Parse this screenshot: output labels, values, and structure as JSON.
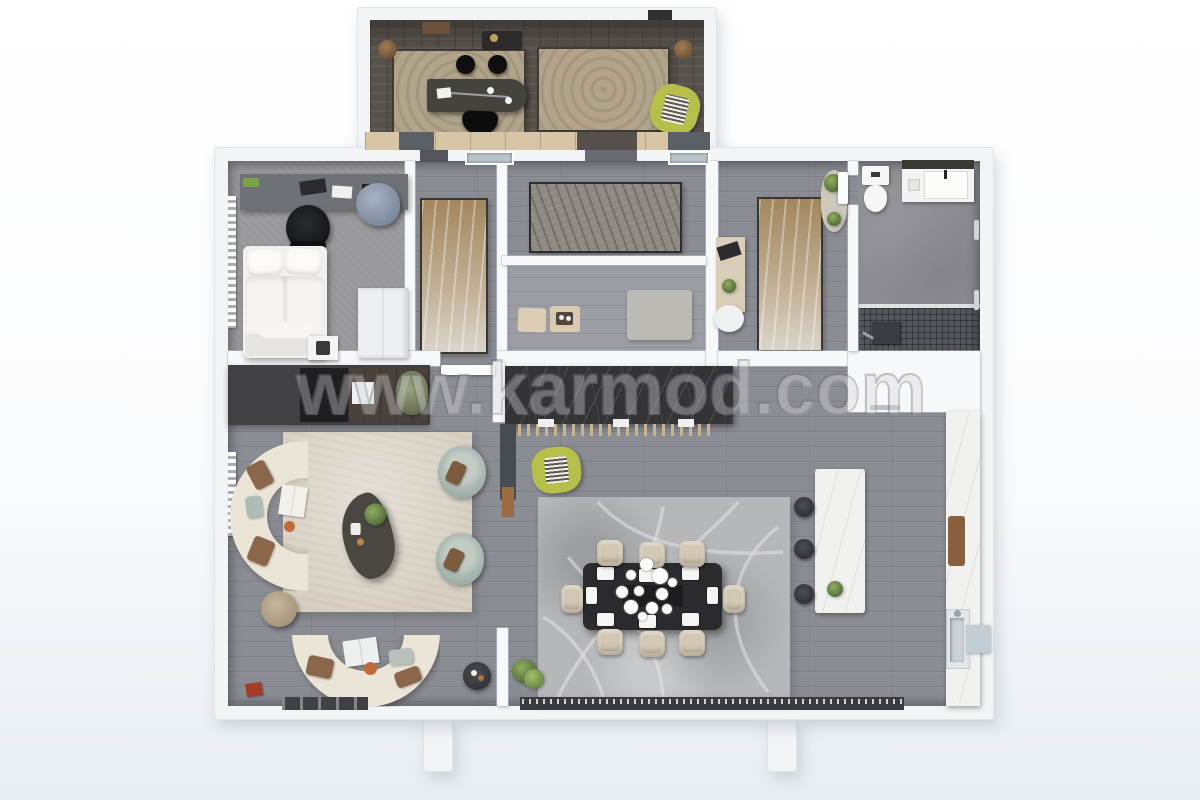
{
  "watermark": {
    "text": "www.karmod.com"
  },
  "scene": {
    "type": "3d-floor-plan-top-view",
    "blocks": [
      "studio-annex",
      "main-house"
    ],
    "colors": {
      "page_bg_bottom": "#e9eef3",
      "outer_wall": "#f2f4f6",
      "floor_wood_gray": "#8b8d94",
      "floor_wood_dark": "#57514b",
      "bedroom_carpet": "#98979a",
      "bathroom_stone": "#8d8c92",
      "shower_mosaic": "#53555c",
      "rug_cream": "#d8d1c3",
      "rug_tan": "#ab9069",
      "rug_beige": "#b2a48b",
      "rug_dining": "#b5b7ba",
      "sofa_cream": "#ebe5d7",
      "armchair_teal": "#a9b7b0",
      "accent_lime": "#b6bf49",
      "counter_dark_marble": "#343338",
      "counter_white_marble": "#f1f2f0",
      "pillow_brown": "#8a674a"
    }
  },
  "rooms": [
    {
      "name": "studio-annex",
      "items": [
        "work-desk",
        "desk-chair",
        "two-bar-stools",
        "beige-area-rug-left",
        "beige-area-rug-right",
        "lime-lounge-chair",
        "storage-cabinet-row",
        "coffee-station",
        "floor-speakers"
      ]
    },
    {
      "name": "bedroom-left",
      "items": [
        "study-desk",
        "office-chair",
        "bean-bag",
        "double-bed",
        "nightstand",
        "wardrobe",
        "radiator"
      ]
    },
    {
      "name": "bedroom-middle",
      "items": [
        "tan-area-rug",
        "entry-door"
      ]
    },
    {
      "name": "hallway",
      "items": [
        "gray-runner-rug",
        "window",
        "window",
        "door-threshold"
      ]
    },
    {
      "name": "mudroom",
      "items": [
        "small-area-rug",
        "door-mat",
        "door-mat",
        "serving-tray"
      ]
    },
    {
      "name": "bedroom-right",
      "items": [
        "tan-area-rug",
        "oval-rug",
        "vanity-desk",
        "laptop",
        "white-chair",
        "plants"
      ]
    },
    {
      "name": "bathroom",
      "items": [
        "toilet",
        "vanity-sink",
        "walk-in-shower",
        "towel-rails",
        "door"
      ]
    },
    {
      "name": "living-room",
      "items": [
        "media-wall",
        "tv-console",
        "curved-sofa-left",
        "curved-sofa-bottom",
        "teal-armchair",
        "teal-armchair",
        "organic-coffee-table",
        "cream-area-rug",
        "pouf",
        "side-table",
        "radiator",
        "floor-plant",
        "red-book"
      ]
    },
    {
      "name": "dining-room",
      "items": [
        "dining-table",
        "eight-dining-chairs",
        "chandelier",
        "swirl-pattern-rug",
        "dark-marble-bar-counter",
        "lime-bar-chair",
        "floor-plant"
      ]
    },
    {
      "name": "kitchen",
      "items": [
        "marble-island",
        "three-bar-stools",
        "right-marble-counter",
        "sink",
        "cutting-board",
        "appliance-box"
      ]
    }
  ]
}
